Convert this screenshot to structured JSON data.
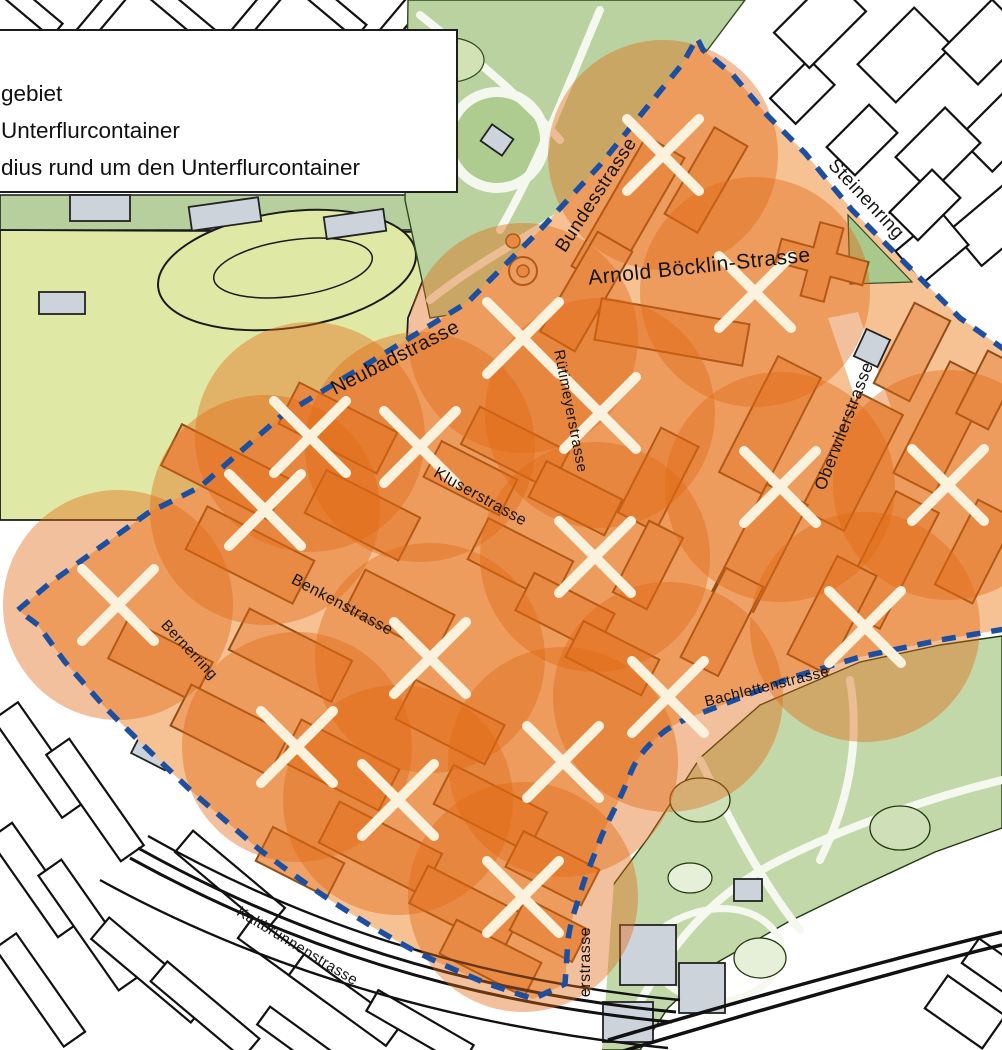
{
  "legend": {
    "items": [
      {
        "label": "gebiet"
      },
      {
        "label": "Unterflurcontainer"
      },
      {
        "label": "dius rund um den Unterflurcontainer"
      }
    ]
  },
  "streets": [
    {
      "id": "bundesstrasse",
      "name": "Bundesstrasse"
    },
    {
      "id": "arnold-boecklin-strasse",
      "name": "Arnold Böcklin-Strasse"
    },
    {
      "id": "steinenring",
      "name": "Steinenring"
    },
    {
      "id": "neubadstrasse",
      "name": "Neubadstrasse"
    },
    {
      "id": "ruetimeyerstrasse",
      "name": "Rütimeyerstrasse"
    },
    {
      "id": "kluserstrasse",
      "name": "Kluserstrasse"
    },
    {
      "id": "oberwilerstrasse",
      "name": "Oberwilerstrasse"
    },
    {
      "id": "benkenstrasse",
      "name": "Benkenstrasse"
    },
    {
      "id": "bernerring",
      "name": "Bernerring"
    },
    {
      "id": "bachlettenstrasse",
      "name": "Bachlettenstrasse"
    },
    {
      "id": "kaltbrunnenstrasse",
      "name": "Kaltbrunnenstrasse"
    },
    {
      "id": "erstrasse-partial",
      "name": "erstrasse"
    }
  ],
  "containers": [
    {
      "x": 663,
      "y": 155
    },
    {
      "x": 755,
      "y": 292
    },
    {
      "x": 523,
      "y": 338
    },
    {
      "x": 600,
      "y": 413
    },
    {
      "x": 310,
      "y": 437
    },
    {
      "x": 420,
      "y": 447
    },
    {
      "x": 265,
      "y": 510
    },
    {
      "x": 780,
      "y": 487
    },
    {
      "x": 948,
      "y": 485
    },
    {
      "x": 118,
      "y": 605
    },
    {
      "x": 595,
      "y": 557
    },
    {
      "x": 430,
      "y": 658
    },
    {
      "x": 865,
      "y": 627
    },
    {
      "x": 668,
      "y": 697
    },
    {
      "x": 297,
      "y": 747
    },
    {
      "x": 563,
      "y": 762
    },
    {
      "x": 398,
      "y": 800
    },
    {
      "x": 523,
      "y": 897
    }
  ],
  "radius_px": 115,
  "colors": {
    "zone_fill": "#f6c193",
    "circle_fill": "#e06a14",
    "boundary_blue": "#1d4fa1",
    "marker_white": "#fbf2dd",
    "building_fill": "#efa268",
    "building_stroke": "#8f4e17",
    "park_green": "#bad2a0",
    "field_green": "#e0e8a6"
  }
}
